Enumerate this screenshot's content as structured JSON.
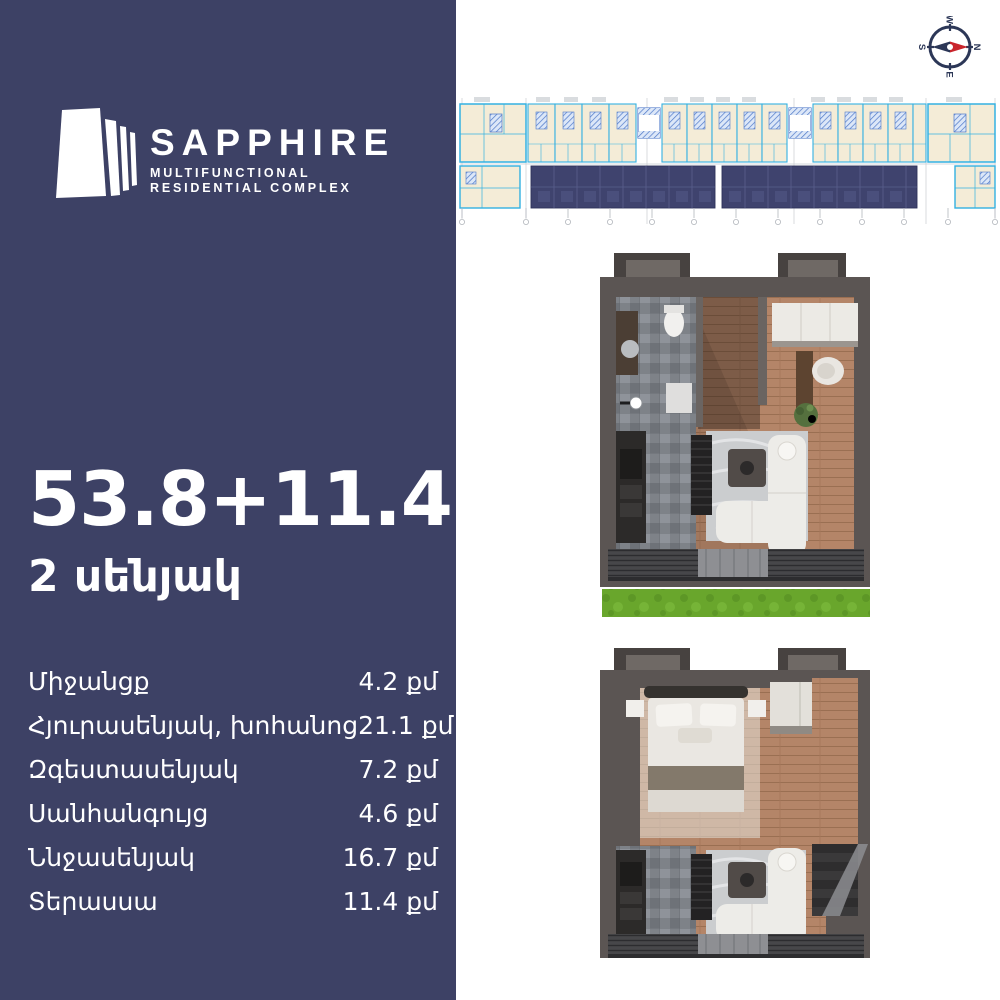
{
  "brand": {
    "name": "SAPPHIRE",
    "tagline_line1": "MULTIFUNCTIONAL",
    "tagline_line2": "RESIDENTIAL COMPLEX"
  },
  "apartment": {
    "area_value": "53.8+11.4",
    "area_unit": "քմ",
    "rooms_label": "2 սենյակ"
  },
  "room_list": [
    {
      "label": "Միջանցք",
      "value": "4.2 քմ"
    },
    {
      "label": "Հյուրասենյակ, խոհանոց",
      "value": "21.1 քմ"
    },
    {
      "label": "Զգեստասենյակ",
      "value": "7.2 քմ"
    },
    {
      "label": "Սանհանգույց",
      "value": "4.6 քմ"
    },
    {
      "label": "Ննջասենյակ",
      "value": "16.7 քմ"
    },
    {
      "label": "Տերասսա",
      "value": "11.4 քմ"
    }
  ],
  "compass": {
    "n": "N",
    "s": "S",
    "e": "E",
    "w": "W"
  },
  "colors": {
    "panel_navy": "#3d4165",
    "plan_cyan": "#33b1e2",
    "plan_beige": "#f4ecd7",
    "plan_highlight": "#3f436e",
    "compass_navy": "#2c3757",
    "compass_red": "#c9252c",
    "grass_green": "#69a62c"
  }
}
